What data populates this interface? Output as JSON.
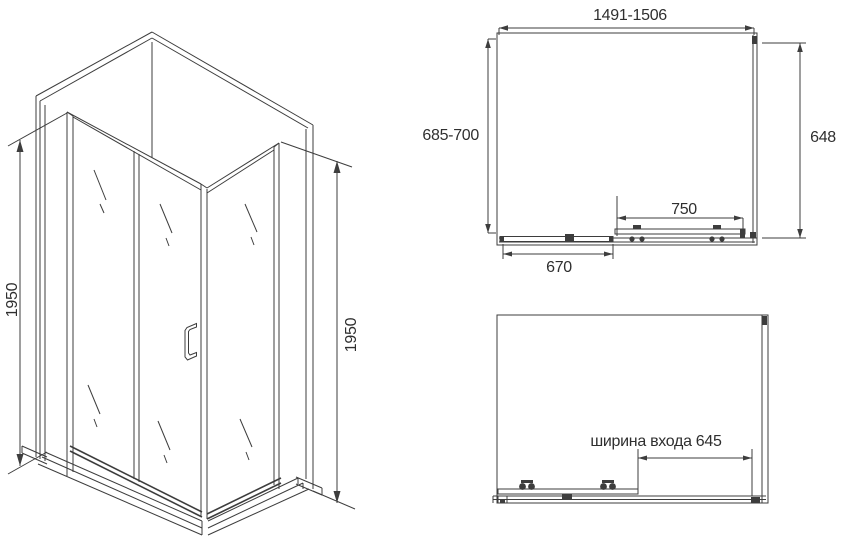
{
  "views": {
    "isometric": {
      "left_height": "1950",
      "right_height": "1950"
    },
    "top_plan": {
      "total_width": "1491-1506",
      "depth_range": "685-700",
      "side_panel_depth": "648",
      "sliding_door_width": "750",
      "fixed_panel_width": "670"
    },
    "front_open": {
      "entrance_width": "ширина входа 645"
    }
  },
  "colors": {
    "line": "#3d3d3d",
    "text": "#2f2f2f",
    "background": "#ffffff"
  }
}
